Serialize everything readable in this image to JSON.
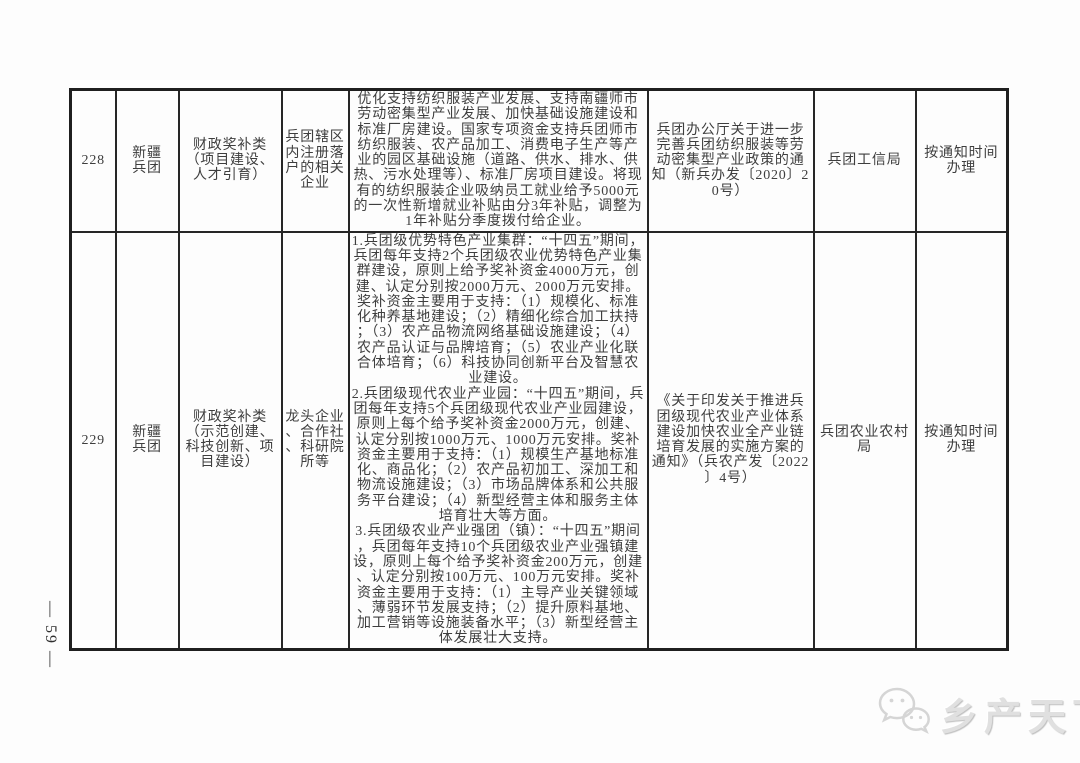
{
  "page": {
    "page_number": "— 59 —",
    "watermark_text": "乡产天下"
  },
  "table": {
    "rows": [
      {
        "no": "228",
        "region": "新疆\n兵团",
        "category": "财政奖补类\n（项目建设、\n人才引育）",
        "target": "兵团辖区内注册落户的相关企业",
        "content": "优化支持纺织服装产业发展、支持南疆师市劳动密集型产业发展、加快基础设施建设和标准厂房建设。国家专项资金支持兵团师市纺织服装、农产品加工、消费电子生产等产业的园区基础设施（道路、供水、排水、供热、污水处理等）、标准厂房项目建设。将现有的纺织服装企业吸纳员工就业给予5000元的一次性新增就业补贴由分3年补贴，调整为1年补贴分季度拨付给企业。",
        "document": "兵团办公厅关于进一步完善兵团纺织服装等劳动密集型产业政策的通知（新兵办发〔2020〕20号）",
        "department": "兵团工信局",
        "schedule": "按通知时间\n办理"
      },
      {
        "no": "229",
        "region": "新疆\n兵团",
        "category": "财政奖补类\n（示范创建、\n科技创新、项\n目建设）",
        "target": "龙头企业、合作社、科研院所等",
        "content": "1.兵团级优势特色产业集群：“十四五”期间，兵团每年支持2个兵团级农业优势特色产业集群建设，原则上给予奖补资金4000万元，创建、认定分别按2000万元、2000万元安排。奖补资金主要用于支持：（1）规模化、标准化种养基地建设；（2）精细化综合加工扶持；（3）农产品物流网络基础设施建设；（4）农产品认证与品牌培育；（5）农业产业化联合体培育；（6）科技协同创新平台及智慧农业建设。\n2.兵团级现代农业产业园：“十四五”期间，兵团每年支持5个兵团级现代农业产业园建设，原则上每个给予奖补资金2000万元，创建、认定分别按1000万元、1000万元安排。奖补资金主要用于支持：（1）规模生产基地标准化、商品化；（2）农产品初加工、深加工和物流设施建设；（3）市场品牌体系和公共服务平台建设；（4）新型经营主体和服务主体培育壮大等方面。\n3.兵团级农业产业强团（镇）：“十四五”期间，兵团每年支持10个兵团级农业产业强镇建设，原则上每个给予奖补资金200万元，创建、认定分别按100万元、100万元安排。奖补资金主要用于支持：（1）主导产业关键领域、薄弱环节发展支持；（2）提升原料基地、加工营销等设施装备水平；（3）新型经营主体发展壮大支持。",
        "document": "《关于印发关于推进兵团级现代农业产业体系建设加快农业全产业链培育发展的实施方案的通知》（兵农产发〔2022〕4号）",
        "department": "兵团农业农村局",
        "schedule": "按通知时间\n办理"
      }
    ]
  }
}
